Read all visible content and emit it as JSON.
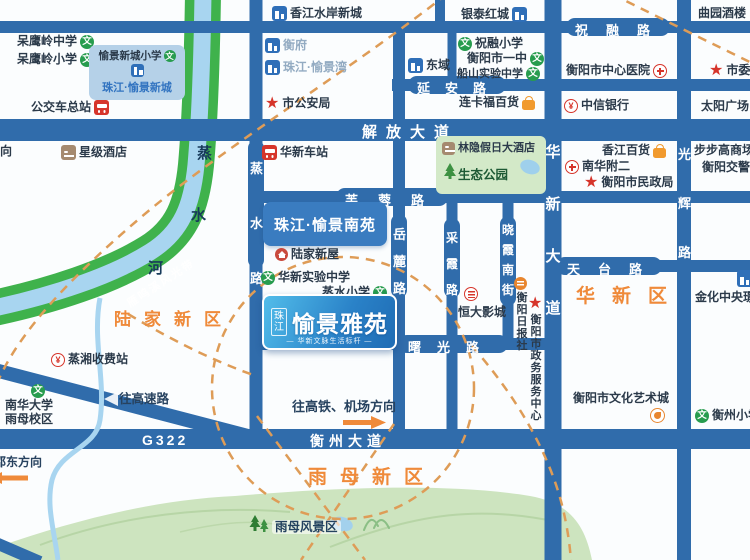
{
  "regions": {
    "lujia": "陆家新区",
    "huaxin": "华新区",
    "yumu": "雨母新区"
  },
  "roads": {
    "zhurong": "祝融路",
    "yanan": "延安路",
    "jiefang": "解放大道",
    "furong": "芙蓉路",
    "tiantai": "天台路",
    "shuguang": "曙光路",
    "hengzhou_ave": "衡州大道",
    "g322": "G322",
    "huaxin_ave": "华新大道",
    "guanghui": "光辉路",
    "zhengshui_rd": "蒸水路",
    "yuelu": "岳麓路",
    "caixia": "采霞路",
    "xiaoxia_south": "晓霞南街"
  },
  "river": {
    "name_chars": [
      "蒸",
      "水",
      "河"
    ],
    "belt": "雁鸣溪风光带"
  },
  "logo": {
    "brand": "珠江",
    "name": "愉景雅苑",
    "tagline": "— 华新文脉生活标杆 —"
  },
  "pois": {
    "daying_middle": "呆鹰岭中学",
    "daying_primary": "呆鹰岭小学",
    "yujing_xincheng_school": "愉景新城小学",
    "zhujiang_yujing_xincheng": "珠江·愉景新城",
    "bus_terminal": "公交车总站",
    "xiangjiang_shuian": "香江水岸新城",
    "hengfu": "衡府",
    "zhujiang_yujingwan": "珠江·愉景湾",
    "dongyu": "东域",
    "zhurong_primary": "祝融小学",
    "hengyang_yizhong": "衡阳市一中",
    "chuanshan_school": "船山实验中学",
    "yintai_hongcheng": "银泰红城",
    "quyuan_jiulou": "曲园酒楼",
    "shiwei": "市委",
    "central_hospital": "衡阳市中心医院",
    "shi_gonganju": "市公安局",
    "liankafu": "连卡福百货",
    "citic_bank": "中信银行",
    "taiyang_square": "太阳广场",
    "xingji_hotel": "星级酒店",
    "direction_partial": "向",
    "huaxin_station": "华新车站",
    "linyin_hotel": "林隐假日大酒店",
    "shengtai_park": "生态公园",
    "nanyuan": "珠江·愉景南苑",
    "lujia_xinwu": "陆家新屋",
    "huaxin_shiyan": "华新实验中学",
    "zhengshui_primary": "蒸水小学",
    "hengda_cinema": "恒大影城",
    "ribaoshe": "衡阳日报社",
    "zhengwu_center": "衡阳市政务服务中心",
    "xiangjiang_baihuo": "香江百货",
    "nanhua_fuer": "南华附二",
    "minzhengju": "衡阳市民政局",
    "bubugao": "步步高商场",
    "hengyang_jiaojing": "衡阳交警",
    "jinhua_central": "金化中央璟",
    "wenhua_art_city": "衡阳市文化艺术城",
    "hengzhou_primary": "衡州小学",
    "zhengxiang_toll": "蒸湘收费站",
    "nanhua_univ_l1": "南华大学",
    "nanhua_univ_l2": "雨母校区",
    "to_expressway": "往高速路",
    "to_hsr": "往高铁、机场方向",
    "shaodong_dir": "邵东方向",
    "yumu_scenic": "雨母风景区"
  },
  "colors": {
    "road": "#306cab",
    "region_orange": "#ef8a3a",
    "river_green": "#3fb24c",
    "river_blue": "#a8d5f0",
    "school_green": "#279c4e",
    "poi_red": "#d6352b",
    "bag_orange": "#f19a2e",
    "dash_orange": "#de9c57",
    "park_green": "#cde4bf"
  }
}
